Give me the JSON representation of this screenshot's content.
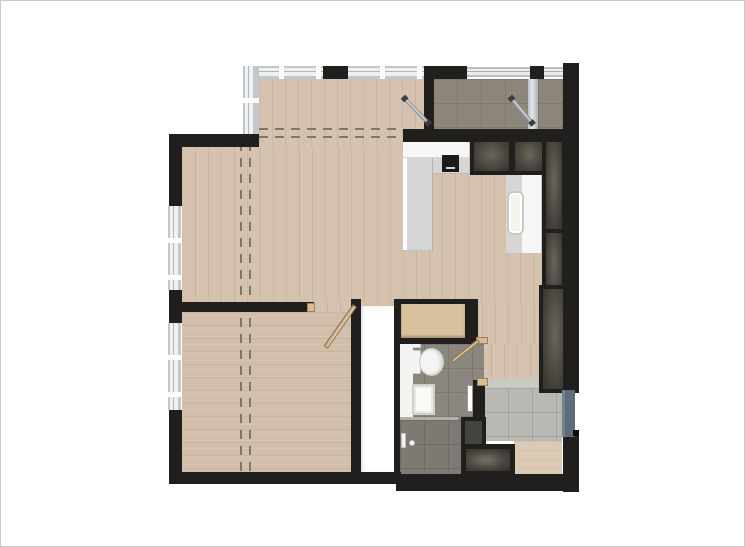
{
  "figure": {
    "kind": "apartment-floor-plan-top-view",
    "text_labels": [],
    "canvas": {
      "width": 745,
      "height": 547
    }
  },
  "palette": {
    "wall": "#201f1d",
    "wood": "#d5c2ae",
    "wood2": "#d2bfab",
    "balcony": "#8d877b",
    "bath": "#8b867e",
    "shower": "#7e7972",
    "entry": "#b9b8b3",
    "threshold": "#c8cbc0",
    "mat": "#dbcab6",
    "tan": "#d9c19d",
    "tanDoor": "#d8bd96",
    "counter": "#f7f7f7",
    "counterGray": "#d6d6d6",
    "sink": "#f2f5ec",
    "closetA": "#6a665b",
    "closetB": "#3a3833",
    "glass": "#eef0f2",
    "frame": "#b0b6bc",
    "door": "#5d6c7b",
    "dash": "#80766a",
    "hall": "#ffffff",
    "divider": "#b4b0a9",
    "pageBorder": "#c9c9c9"
  },
  "rooms": [
    {
      "name": "living-room",
      "floor": "wood-vertical-planks"
    },
    {
      "name": "bedroom",
      "floor": "wood-horizontal-planks"
    },
    {
      "name": "kitchen",
      "floor": "wood-vertical-planks"
    },
    {
      "name": "corridor",
      "floor": "wood-vertical-planks"
    },
    {
      "name": "balcony",
      "floor": "gray-tile"
    },
    {
      "name": "bathroom",
      "floor": "gray-tile"
    },
    {
      "name": "shower-area",
      "floor": "dark-gray-tile"
    },
    {
      "name": "entry",
      "floor": "light-gray-tile"
    },
    {
      "name": "hall-closet",
      "floor": "white"
    }
  ],
  "fixtures": [
    "kitchen-counter",
    "cooktop",
    "kitchen-sink",
    "wardrobe-closets",
    "toilet",
    "vanity-sink",
    "shower-fixture",
    "washer",
    "appliance",
    "entry-door",
    "genkan-mat",
    "tan-cabinet"
  ]
}
